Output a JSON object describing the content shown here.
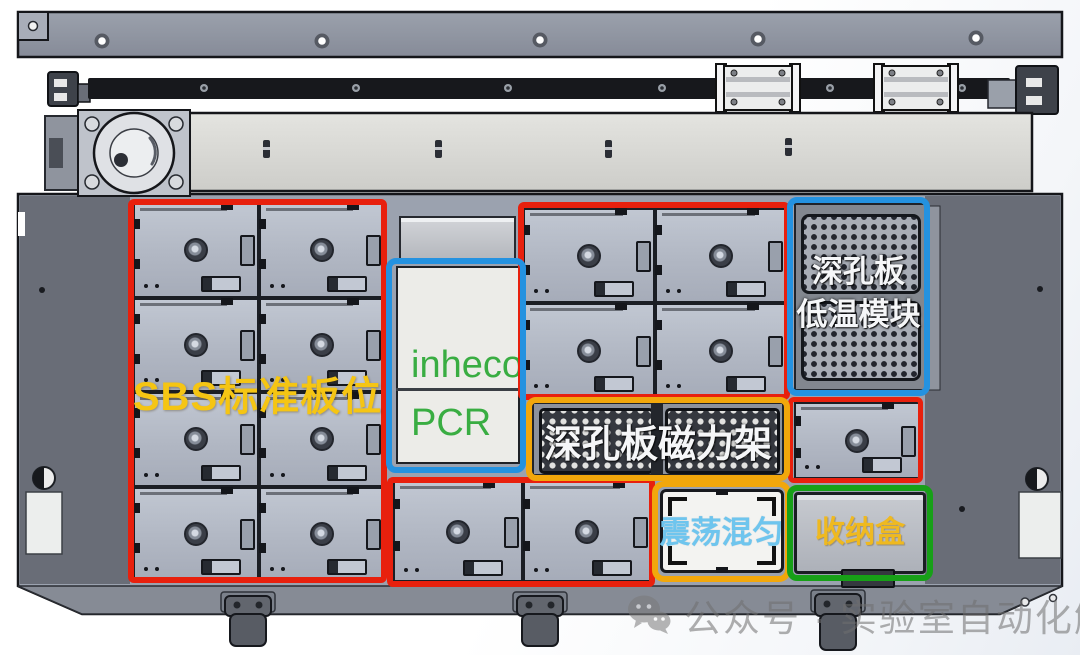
{
  "image_type": "annotated CAD render of laboratory automation deck layout",
  "colors": {
    "red_outline": "#e8200d",
    "blue_outline": "#2492e0",
    "orange_outline": "#f2a70b",
    "green_outline": "#17a017",
    "yellow_label": "#f5c513",
    "green_label": "#39ad42",
    "white_label": "#f5f6f8",
    "lightblue_label": "#6ec5ee",
    "storage_label": "#efb920",
    "watermark_gray": "#6f6f6f"
  },
  "regions": {
    "sbs": {
      "label": "SBS标准板位"
    },
    "inheco": {
      "line1": "inheco",
      "line2": "PCR"
    },
    "cold_module": {
      "line1": "深孔板",
      "line2": "低温模块"
    },
    "magnetic_rack": {
      "label": "深孔板磁力架"
    },
    "shaker": {
      "label": "震荡混匀"
    },
    "storage": {
      "label": "收纳盒"
    }
  },
  "plate_grids": {
    "left": {
      "rows": 4,
      "cols": 2
    },
    "top_mid": {
      "rows": 2,
      "cols": 2
    },
    "bottom_mid": {
      "rows": 1,
      "cols": 2
    },
    "right_single": {
      "rows": 1,
      "cols": 1
    }
  },
  "watermark": {
    "icon": "wechat-icon",
    "text": "公众号 · 实验室自动化解析"
  }
}
